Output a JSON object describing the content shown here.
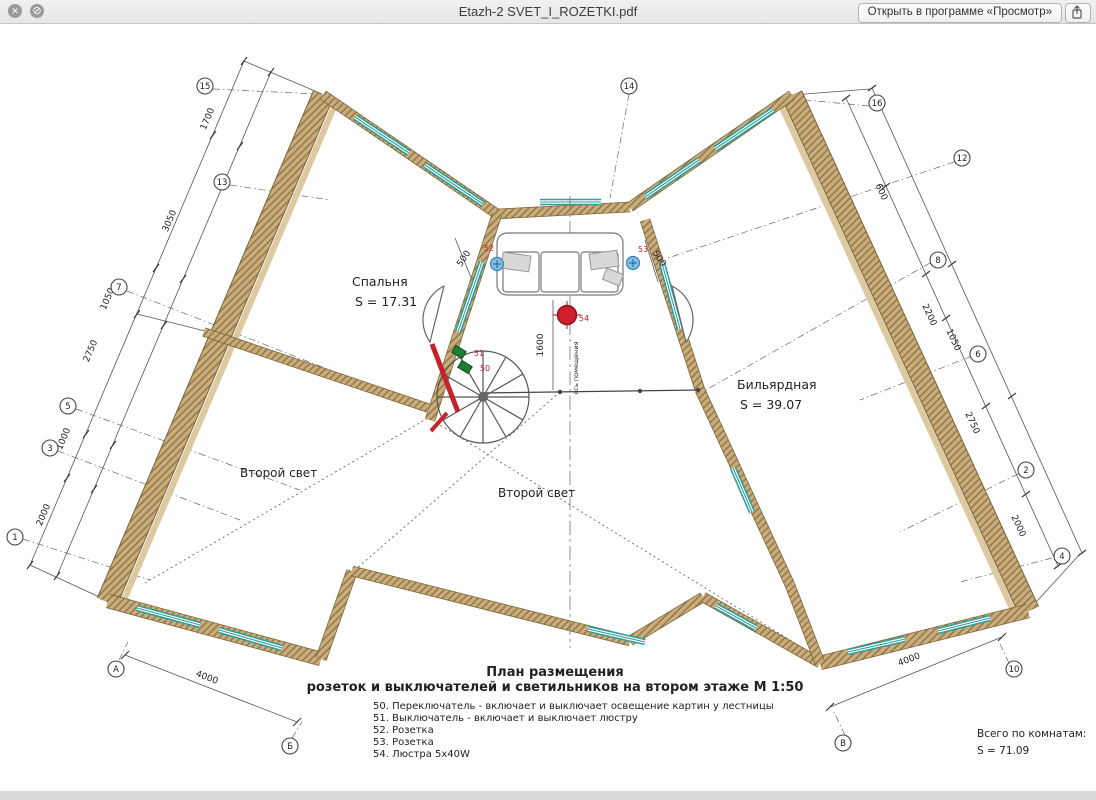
{
  "window": {
    "title": "Etazh-2 SVET_I_ROZETKI.pdf",
    "open_button_label": "Открыть в программе «Просмотр»",
    "icons": {
      "close": "✕",
      "prohibit": "⊘",
      "share": "share-icon"
    }
  },
  "plan": {
    "rooms": [
      {
        "name": "Спальня",
        "area": "S  =  17.31"
      },
      {
        "name": "Бильярдная",
        "area": "S  =  39.07"
      }
    ],
    "zones": [
      "Второй свет",
      "Второй свет"
    ],
    "axis_label": "ось помещения",
    "caption": {
      "line1": "План размещения",
      "line2": "розеток и выключателей и светильников на втором этаже  М 1:50"
    },
    "legend": [
      "50. Переключатель - включает и выключает освещение картин у лестницы",
      "51. Выключатель - включает и выключает люстру",
      "52. Розетка",
      "53. Розетка",
      "54. Люстра 5x40W"
    ],
    "totals": {
      "line1": "Всего по комнатам:",
      "line2": "S  =  71.09"
    },
    "devices": {
      "switch_upper": "51",
      "switch_lower": "50",
      "socket_left": "52",
      "socket_right": "53",
      "chandelier": "54"
    },
    "dims": {
      "left": [
        "1700",
        "3050",
        "1050",
        "2750",
        "1000",
        "2000"
      ],
      "right": [
        "600",
        "2200",
        "1050",
        "2750",
        "2000"
      ],
      "bottom_left": "4000",
      "bottom_right": "4000",
      "center": {
        "sofa_left": "500",
        "sofa_right": "500",
        "chandelier_offset": "1600"
      }
    },
    "grid_bubbles": {
      "left": [
        "15",
        "13",
        "7",
        "5",
        "3",
        "1"
      ],
      "right": [
        "16",
        "12",
        "8",
        "6",
        "2",
        "4",
        "10"
      ],
      "top": [
        "14"
      ],
      "bottom": [
        "А",
        "Б",
        "В"
      ]
    },
    "colors": {
      "wall": "#c9ad7c",
      "wall_hatch": "#8f7344",
      "window": "#2f9d99",
      "device_red": "#cc1f2e",
      "switch_green": "#1c7e33",
      "socket_blue": "#7cc0e8"
    }
  }
}
